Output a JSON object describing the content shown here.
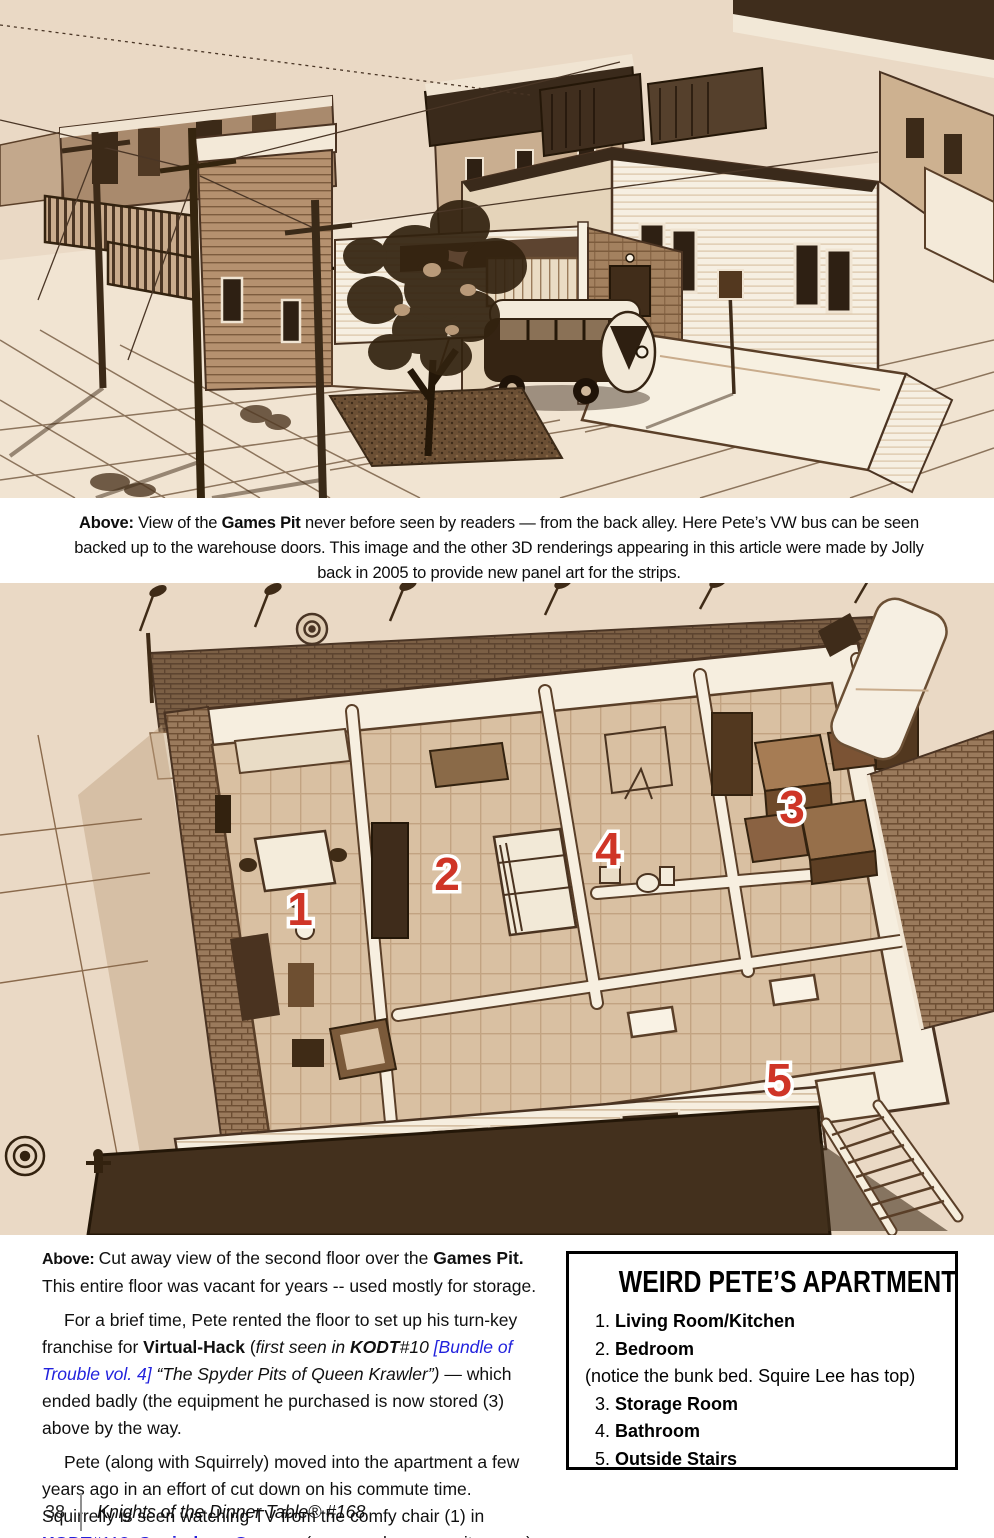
{
  "palette": {
    "paper": "#ffffff",
    "sepia_light": "#ead9c5",
    "sepia_mid": "#b5916f",
    "sepia_dark": "#3f2c1a",
    "roof_dark": "#43301d",
    "label_red": "#cf3527",
    "link_blue": "#2222dd"
  },
  "caption_top": {
    "lead": "Above: ",
    "a": "View of the ",
    "b": "Games Pit",
    "c": " never before seen by readers — from the back alley. Here Pete’s VW bus can be seen backed up to the warehouse doors.  This image and the other 3D renderings appearing in this article were made by Jolly back in 2005 to provide new panel art for the strips."
  },
  "article": {
    "p1": {
      "lead": "Above: ",
      "a": "Cut away view of the second floor over the ",
      "b": "Games Pit.",
      "c": " This entire floor was vacant for years -- used mostly for storage."
    },
    "p2": {
      "a": "For a brief time, Pete rented the floor to set up his turn-key franchise for ",
      "b": "Virtual-Hack",
      "c": " (",
      "d": "first seen in ",
      "e": "KODT",
      "f": "#10 ",
      "g": "[Bundle of Trouble vol. 4]",
      "h": " “The Spyder Pits of Queen Krawler”)",
      "i": " — which ended badly (the equipment he purchased is now stored (3) above by the way."
    },
    "p3": {
      "a": "Pete (along with Squirrely) moved into the apartment a few years ago in an effort of cut down on his commute time. Squirrelly is seen watching TV from the comfy chair (1) in ",
      "b": "KODT",
      "c": "#113: ",
      "d": "Squirelous George",
      "e": ". (see panel on opposite page)"
    }
  },
  "sidebar": {
    "title": "WEIRD PETE’S APARTMENT",
    "items": [
      {
        "num": "1. ",
        "label": "Living Room/Kitchen"
      },
      {
        "num": "2. ",
        "label": "Bedroom"
      },
      {
        "num": "3. ",
        "label": "Storage Room"
      },
      {
        "num": "4. ",
        "label": "Bathroom"
      },
      {
        "num": "5. ",
        "label": "Outside Stairs"
      }
    ],
    "bedroom_note": "(notice the bunk bed. Squire Lee has top)"
  },
  "floorplan": {
    "labels": [
      {
        "text": "1"
      },
      {
        "text": "2"
      },
      {
        "text": "3"
      },
      {
        "text": "4"
      },
      {
        "text": "5"
      }
    ]
  },
  "footer": {
    "page_number": "38",
    "magazine": "Knights of the Dinner Table® #168"
  }
}
